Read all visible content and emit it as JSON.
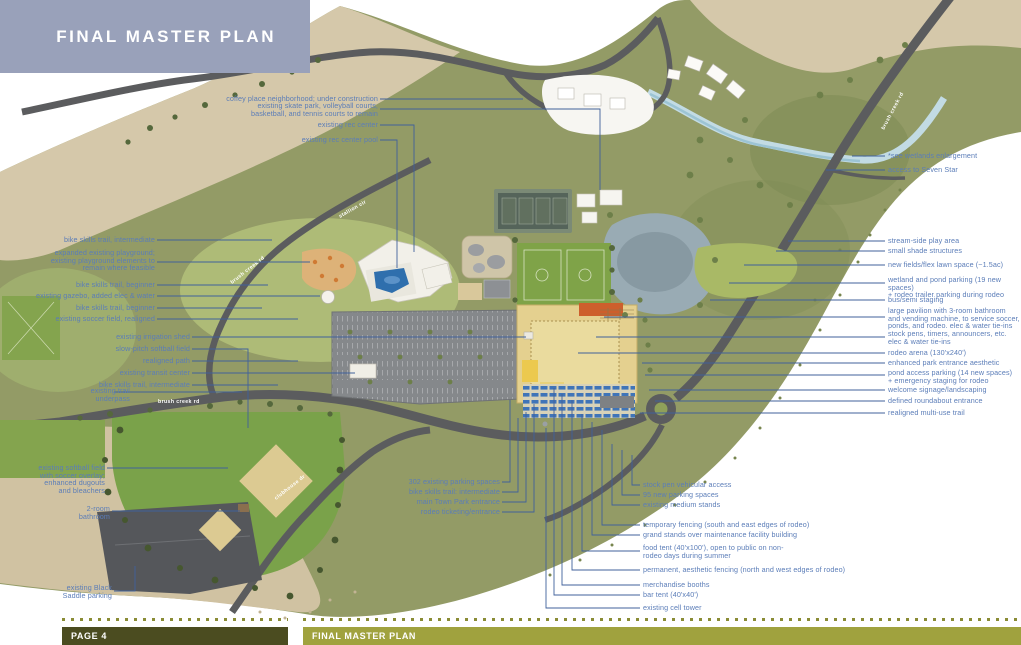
{
  "header": {
    "title": "FINAL MASTER PLAN"
  },
  "footer": {
    "page_label": "PAGE 4",
    "title": "FINAL MASTER PLAN"
  },
  "colors": {
    "header_bg": "#99a1ba",
    "callout_text": "#5b7db8",
    "leader_line": "#40619b",
    "footer_left_bg": "#4b4c20",
    "footer_right_bg": "#a0a23e",
    "footer_dots": "#8a8c35",
    "road": "#5b5c5e",
    "pond": "#99abb4",
    "sand": "#d5c8aa",
    "field_green": "#7fa348",
    "rodeo_sand": "#e4d08f"
  },
  "map": {
    "road_labels": {
      "brush_creek_top": "brush creek rd",
      "brush_creek_mid": "brush creek rd",
      "brush_creek_lower": "brush creek rd",
      "stallion": "stallion cir",
      "clubhouse": "clubhouse dr"
    }
  },
  "callouts": {
    "top_left": [
      {
        "text": "coffey place neighborhood; under construction"
      },
      {
        "text": "existing skate park, volleyball courts,\nbasketball, and tennis courts to remain"
      },
      {
        "text": "existing rec center"
      },
      {
        "text": "existing rec center pool"
      }
    ],
    "left": [
      {
        "text": "bike skills trail, intermediate"
      },
      {
        "text": "expanded existing playground;\nexisting playground elements to\nremain where feasible"
      },
      {
        "text": "bike skills trail, beginner"
      },
      {
        "text": "existing gazebo, added elec & water"
      },
      {
        "text": "bike skills trail, beginner"
      },
      {
        "text": "existing soccer field, realigned"
      },
      {
        "text": "existing irrigation shed"
      },
      {
        "text": "slow-pitch softball field"
      },
      {
        "text": "realigned path"
      },
      {
        "text": "existing transit center"
      },
      {
        "text": "bike skills trail, intermediate"
      },
      {
        "text": "existing trail\nunderpass"
      }
    ],
    "bottom_left": [
      {
        "text": "existing softball field\nwith soccer overlay;\nenhanced dugouts\nand bleachers"
      },
      {
        "text": "2-room\nbathroom"
      },
      {
        "text": "existing Black\nSaddle parking"
      }
    ],
    "bottom_center": [
      {
        "text": "302 existing parking spaces"
      },
      {
        "text": "bike skills trail: intermediate"
      },
      {
        "text": "main Town Park entrance"
      },
      {
        "text": "rodeo ticketing/entrance"
      }
    ],
    "bottom_right": [
      {
        "text": "stock pen vehicular access"
      },
      {
        "text": "95 new parking spaces"
      },
      {
        "text": "existing medium stands"
      },
      {
        "text": "temporary fencing (south and east edges of rodeo)"
      },
      {
        "text": "grand stands over maintenance facility building"
      },
      {
        "text": "food tent (40'x100'), open to public on non-\nrodeo days during summer"
      },
      {
        "text": "permanent, aesthetic fencing (north and west edges of rodeo)"
      },
      {
        "text": "merchandise booths"
      },
      {
        "text": "bar tent (40'x40')"
      },
      {
        "text": "existing cell tower"
      }
    ],
    "right": [
      {
        "text": "*see wetlands enlargement"
      },
      {
        "text": "access to Seven Star"
      },
      {
        "text": "stream-side play area"
      },
      {
        "text": "small shade structures"
      },
      {
        "text": "new fields/flex lawn space (~1.5ac)"
      },
      {
        "text": "wetland and pond parking (19 new spaces)\n+ rodeo trailer parking during rodeo"
      },
      {
        "text": "bus/semi staging"
      },
      {
        "text": "large pavilion with 3-room bathroom\nand vending machine, to service soccer,\nponds, and rodeo. elec & water tie-ins"
      },
      {
        "text": "stock pens, timers, announcers, etc.\nelec & water tie-ins"
      },
      {
        "text": "rodeo arena (130'x240')"
      },
      {
        "text": "enhanced park entrance aesthetic"
      },
      {
        "text": "pond access parking (14 new spaces)\n+ emergency staging for rodeo"
      },
      {
        "text": "welcome signage/landscaping"
      },
      {
        "text": "defined roundabout entrance"
      },
      {
        "text": "realigned multi-use trail"
      }
    ]
  }
}
